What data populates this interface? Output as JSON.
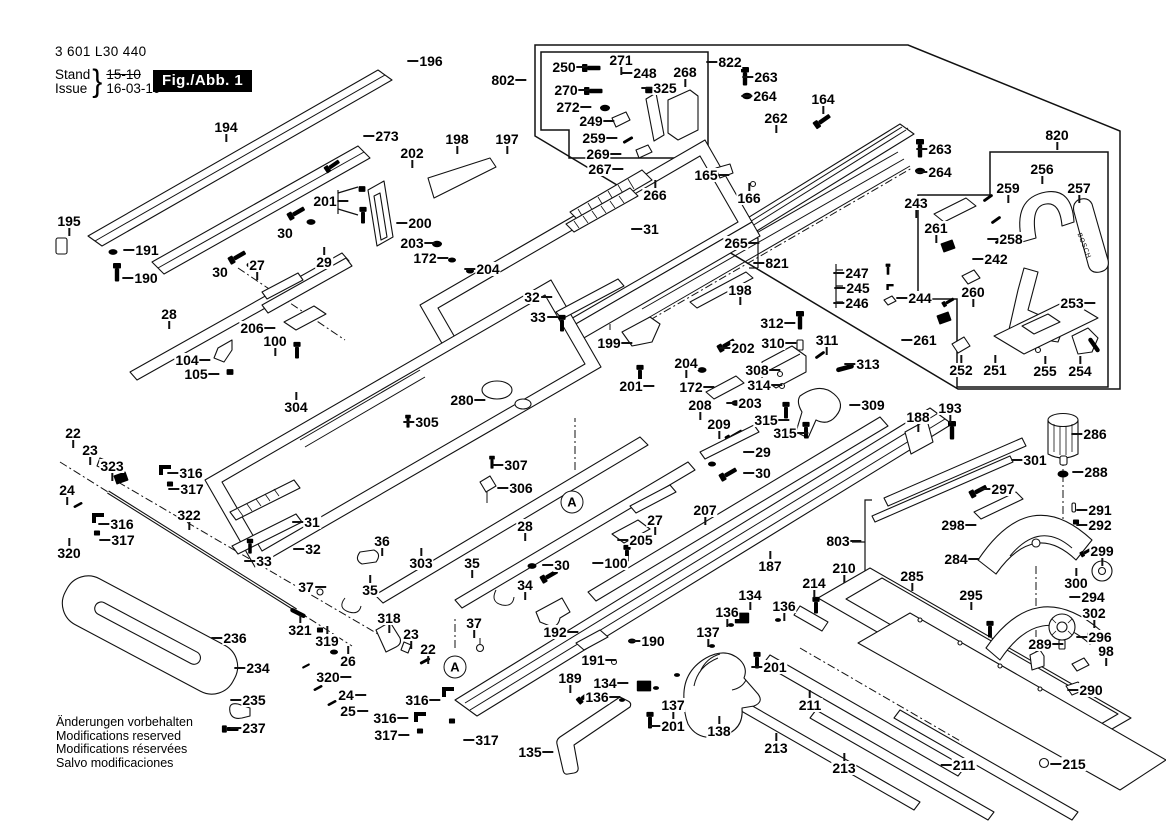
{
  "doc": {
    "part_number": "3 601 L30 440",
    "stand_label": "Stand",
    "issue_label": "Issue",
    "stand_value": "15-10",
    "issue_value": "16-03-10",
    "figure_badge": "Fig./Abb. 1",
    "footer_lines": [
      "Änderungen vorbehalten",
      "Modifications reserved",
      "Modifications réservées",
      "Salvo modificaciones"
    ],
    "brand_on_part": "BOSCH",
    "detail_marker": "A"
  },
  "markers": [
    {
      "t": "A",
      "x": 572,
      "y": 502
    },
    {
      "t": "A",
      "x": 455,
      "y": 667
    }
  ],
  "labels": [
    {
      "t": "194",
      "x": 226,
      "y": 127,
      "d": "b"
    },
    {
      "t": "196",
      "x": 431,
      "y": 61,
      "d": "l"
    },
    {
      "t": "273",
      "x": 387,
      "y": 136,
      "d": "l"
    },
    {
      "t": "198",
      "x": 457,
      "y": 139,
      "d": "b"
    },
    {
      "t": "197",
      "x": 507,
      "y": 139,
      "d": "b"
    },
    {
      "t": "202",
      "x": 412,
      "y": 153,
      "d": "b"
    },
    {
      "t": "195",
      "x": 69,
      "y": 221,
      "d": "b"
    },
    {
      "t": "191",
      "x": 147,
      "y": 250,
      "d": "l"
    },
    {
      "t": "190",
      "x": 146,
      "y": 278,
      "d": "l"
    },
    {
      "t": "201",
      "x": 325,
      "y": 201,
      "d": "r"
    },
    {
      "t": "30",
      "x": 285,
      "y": 233
    },
    {
      "t": "30",
      "x": 220,
      "y": 272
    },
    {
      "t": "27",
      "x": 257,
      "y": 265,
      "d": "b"
    },
    {
      "t": "29",
      "x": 324,
      "y": 262,
      "d": "t"
    },
    {
      "t": "200",
      "x": 420,
      "y": 223,
      "d": "l"
    },
    {
      "t": "203",
      "x": 412,
      "y": 243,
      "d": "r"
    },
    {
      "t": "172",
      "x": 425,
      "y": 258,
      "d": "r"
    },
    {
      "t": "204",
      "x": 488,
      "y": 269,
      "d": "l"
    },
    {
      "t": "28",
      "x": 169,
      "y": 314,
      "d": "b"
    },
    {
      "t": "206",
      "x": 252,
      "y": 328,
      "d": "r"
    },
    {
      "t": "100",
      "x": 275,
      "y": 341,
      "d": "b"
    },
    {
      "t": "104",
      "x": 187,
      "y": 360,
      "d": "r"
    },
    {
      "t": "105",
      "x": 196,
      "y": 374,
      "d": "r"
    },
    {
      "t": "304",
      "x": 296,
      "y": 407,
      "d": "t"
    },
    {
      "t": "802",
      "x": 503,
      "y": 80,
      "d": "r"
    },
    {
      "t": "250",
      "x": 564,
      "y": 67,
      "d": "r"
    },
    {
      "t": "271",
      "x": 621,
      "y": 60,
      "d": "b"
    },
    {
      "t": "248",
      "x": 645,
      "y": 73,
      "d": "l"
    },
    {
      "t": "268",
      "x": 685,
      "y": 72,
      "d": "b"
    },
    {
      "t": "325",
      "x": 665,
      "y": 88,
      "d": "l"
    },
    {
      "t": "270",
      "x": 566,
      "y": 90,
      "d": "r"
    },
    {
      "t": "272",
      "x": 568,
      "y": 107,
      "d": "r"
    },
    {
      "t": "249",
      "x": 591,
      "y": 121,
      "d": "r"
    },
    {
      "t": "259",
      "x": 594,
      "y": 138,
      "d": "r"
    },
    {
      "t": "269",
      "x": 598,
      "y": 154,
      "d": "r"
    },
    {
      "t": "267",
      "x": 600,
      "y": 169,
      "d": "r"
    },
    {
      "t": "266",
      "x": 655,
      "y": 195,
      "d": "t"
    },
    {
      "t": "822",
      "x": 730,
      "y": 62,
      "d": "l"
    },
    {
      "t": "263",
      "x": 766,
      "y": 77,
      "d": "l"
    },
    {
      "t": "264",
      "x": 765,
      "y": 96,
      "d": "l"
    },
    {
      "t": "164",
      "x": 823,
      "y": 99,
      "d": "b"
    },
    {
      "t": "262",
      "x": 776,
      "y": 118,
      "d": "b"
    },
    {
      "t": "263",
      "x": 940,
      "y": 149,
      "d": "l"
    },
    {
      "t": "264",
      "x": 940,
      "y": 172,
      "d": "l"
    },
    {
      "t": "820",
      "x": 1057,
      "y": 135,
      "d": "b"
    },
    {
      "t": "256",
      "x": 1042,
      "y": 169,
      "d": "b"
    },
    {
      "t": "259",
      "x": 1008,
      "y": 188,
      "d": "b"
    },
    {
      "t": "257",
      "x": 1079,
      "y": 188,
      "d": "b"
    },
    {
      "t": "258",
      "x": 1011,
      "y": 239,
      "d": "l"
    },
    {
      "t": "242",
      "x": 996,
      "y": 259,
      "d": "l"
    },
    {
      "t": "243",
      "x": 916,
      "y": 203,
      "d": "b"
    },
    {
      "t": "261",
      "x": 936,
      "y": 228,
      "d": "b"
    },
    {
      "t": "165",
      "x": 706,
      "y": 175,
      "d": "r"
    },
    {
      "t": "166",
      "x": 749,
      "y": 198,
      "d": "t"
    },
    {
      "t": "31",
      "x": 651,
      "y": 229,
      "d": "l"
    },
    {
      "t": "265",
      "x": 736,
      "y": 243,
      "d": "r"
    },
    {
      "t": "821",
      "x": 777,
      "y": 263,
      "d": "l"
    },
    {
      "t": "247",
      "x": 857,
      "y": 273,
      "d": "l"
    },
    {
      "t": "245",
      "x": 858,
      "y": 288,
      "d": "l"
    },
    {
      "t": "246",
      "x": 857,
      "y": 303,
      "d": "l"
    },
    {
      "t": "244",
      "x": 920,
      "y": 298,
      "d": "l"
    },
    {
      "t": "260",
      "x": 973,
      "y": 292,
      "d": "b"
    },
    {
      "t": "253",
      "x": 1072,
      "y": 303,
      "d": "r"
    },
    {
      "t": "261",
      "x": 925,
      "y": 340,
      "d": "l"
    },
    {
      "t": "252",
      "x": 961,
      "y": 370,
      "d": "t"
    },
    {
      "t": "251",
      "x": 995,
      "y": 370,
      "d": "t"
    },
    {
      "t": "255",
      "x": 1045,
      "y": 371,
      "d": "t"
    },
    {
      "t": "254",
      "x": 1080,
      "y": 371,
      "d": "t"
    },
    {
      "t": "313",
      "x": 868,
      "y": 364,
      "d": "l"
    },
    {
      "t": "312",
      "x": 772,
      "y": 323,
      "d": "r"
    },
    {
      "t": "310",
      "x": 773,
      "y": 343,
      "d": "r"
    },
    {
      "t": "311",
      "x": 827,
      "y": 340,
      "d": "b"
    },
    {
      "t": "308",
      "x": 757,
      "y": 370,
      "d": "r"
    },
    {
      "t": "314",
      "x": 759,
      "y": 385,
      "d": "r"
    },
    {
      "t": "309",
      "x": 873,
      "y": 405,
      "d": "l"
    },
    {
      "t": "315",
      "x": 766,
      "y": 420,
      "d": "r"
    },
    {
      "t": "315",
      "x": 785,
      "y": 433,
      "d": "r"
    },
    {
      "t": "188",
      "x": 918,
      "y": 417,
      "d": "b"
    },
    {
      "t": "193",
      "x": 950,
      "y": 408,
      "d": "b"
    },
    {
      "t": "198",
      "x": 740,
      "y": 290,
      "d": "b"
    },
    {
      "t": "202",
      "x": 743,
      "y": 348,
      "d": "l"
    },
    {
      "t": "204",
      "x": 686,
      "y": 363,
      "d": "b"
    },
    {
      "t": "172",
      "x": 691,
      "y": 387,
      "d": "r"
    },
    {
      "t": "203",
      "x": 750,
      "y": 403,
      "d": "l"
    },
    {
      "t": "201",
      "x": 631,
      "y": 386,
      "d": "r"
    },
    {
      "t": "208",
      "x": 700,
      "y": 405,
      "d": "b"
    },
    {
      "t": "209",
      "x": 719,
      "y": 424,
      "d": "b"
    },
    {
      "t": "29",
      "x": 763,
      "y": 452,
      "d": "l"
    },
    {
      "t": "30",
      "x": 763,
      "y": 473,
      "d": "l"
    },
    {
      "t": "32",
      "x": 532,
      "y": 297,
      "d": "r"
    },
    {
      "t": "33",
      "x": 538,
      "y": 317,
      "d": "r"
    },
    {
      "t": "199",
      "x": 609,
      "y": 343,
      "d": "r"
    },
    {
      "t": "280",
      "x": 462,
      "y": 400,
      "d": "r"
    },
    {
      "t": "305",
      "x": 427,
      "y": 422,
      "d": "l"
    },
    {
      "t": "307",
      "x": 516,
      "y": 465,
      "d": "l"
    },
    {
      "t": "306",
      "x": 521,
      "y": 488,
      "d": "l"
    },
    {
      "t": "301",
      "x": 1035,
      "y": 460,
      "d": "l"
    },
    {
      "t": "286",
      "x": 1095,
      "y": 434,
      "d": "l"
    },
    {
      "t": "288",
      "x": 1096,
      "y": 472,
      "d": "l"
    },
    {
      "t": "297",
      "x": 1003,
      "y": 489,
      "d": "l"
    },
    {
      "t": "298",
      "x": 953,
      "y": 525,
      "d": "r"
    },
    {
      "t": "291",
      "x": 1100,
      "y": 510,
      "d": "l"
    },
    {
      "t": "292",
      "x": 1100,
      "y": 525,
      "d": "l"
    },
    {
      "t": "284",
      "x": 956,
      "y": 559,
      "d": "r"
    },
    {
      "t": "299",
      "x": 1102,
      "y": 551,
      "d": "b"
    },
    {
      "t": "300",
      "x": 1076,
      "y": 583,
      "d": "t"
    },
    {
      "t": "294",
      "x": 1093,
      "y": 597,
      "d": "l"
    },
    {
      "t": "302",
      "x": 1094,
      "y": 613,
      "d": "b"
    },
    {
      "t": "285",
      "x": 912,
      "y": 576,
      "d": "b"
    },
    {
      "t": "295",
      "x": 971,
      "y": 595,
      "d": "b"
    },
    {
      "t": "289",
      "x": 1040,
      "y": 644,
      "d": "r"
    },
    {
      "t": "296",
      "x": 1100,
      "y": 637,
      "d": "l"
    },
    {
      "t": "98",
      "x": 1106,
      "y": 651,
      "d": "b"
    },
    {
      "t": "290",
      "x": 1091,
      "y": 690,
      "d": "l"
    },
    {
      "t": "22",
      "x": 73,
      "y": 433,
      "d": "b"
    },
    {
      "t": "23",
      "x": 90,
      "y": 450,
      "d": "b"
    },
    {
      "t": "323",
      "x": 112,
      "y": 466,
      "d": "b"
    },
    {
      "t": "24",
      "x": 67,
      "y": 490,
      "d": "b"
    },
    {
      "t": "316",
      "x": 191,
      "y": 473,
      "d": "l"
    },
    {
      "t": "317",
      "x": 192,
      "y": 489,
      "d": "l"
    },
    {
      "t": "316",
      "x": 122,
      "y": 524,
      "d": "l"
    },
    {
      "t": "317",
      "x": 123,
      "y": 540,
      "d": "l"
    },
    {
      "t": "320",
      "x": 69,
      "y": 553,
      "d": "t"
    },
    {
      "t": "322",
      "x": 189,
      "y": 515,
      "d": "b"
    },
    {
      "t": "31",
      "x": 312,
      "y": 522,
      "d": "l"
    },
    {
      "t": "32",
      "x": 313,
      "y": 549,
      "d": "l"
    },
    {
      "t": "33",
      "x": 264,
      "y": 561,
      "d": "l"
    },
    {
      "t": "36",
      "x": 382,
      "y": 541,
      "d": "b"
    },
    {
      "t": "35",
      "x": 370,
      "y": 590,
      "d": "t"
    },
    {
      "t": "37",
      "x": 306,
      "y": 587,
      "d": "r"
    },
    {
      "t": "303",
      "x": 421,
      "y": 563,
      "d": "t"
    },
    {
      "t": "35",
      "x": 472,
      "y": 563,
      "d": "b"
    },
    {
      "t": "34",
      "x": 525,
      "y": 585,
      "d": "b"
    },
    {
      "t": "28",
      "x": 525,
      "y": 526,
      "d": "b"
    },
    {
      "t": "205",
      "x": 641,
      "y": 540,
      "d": "l"
    },
    {
      "t": "27",
      "x": 655,
      "y": 520,
      "d": "b"
    },
    {
      "t": "100",
      "x": 616,
      "y": 563,
      "d": "l"
    },
    {
      "t": "30",
      "x": 562,
      "y": 565,
      "d": "l"
    },
    {
      "t": "207",
      "x": 705,
      "y": 510,
      "d": "b"
    },
    {
      "t": "187",
      "x": 770,
      "y": 566,
      "d": "t"
    },
    {
      "t": "803",
      "x": 838,
      "y": 541,
      "d": "r"
    },
    {
      "t": "210",
      "x": 844,
      "y": 568,
      "d": "b"
    },
    {
      "t": "214",
      "x": 814,
      "y": 583,
      "d": "b"
    },
    {
      "t": "37",
      "x": 474,
      "y": 623,
      "d": "b"
    },
    {
      "t": "318",
      "x": 389,
      "y": 618,
      "d": "b"
    },
    {
      "t": "23",
      "x": 411,
      "y": 634,
      "d": "b"
    },
    {
      "t": "22",
      "x": 428,
      "y": 649,
      "d": "b"
    },
    {
      "t": "319",
      "x": 327,
      "y": 641,
      "d": "t"
    },
    {
      "t": "26",
      "x": 348,
      "y": 661,
      "d": "t"
    },
    {
      "t": "320",
      "x": 328,
      "y": 677,
      "d": "r"
    },
    {
      "t": "24",
      "x": 346,
      "y": 695,
      "d": "r"
    },
    {
      "t": "25",
      "x": 348,
      "y": 711,
      "d": "r"
    },
    {
      "t": "321",
      "x": 300,
      "y": 630,
      "d": "t"
    },
    {
      "t": "236",
      "x": 235,
      "y": 638,
      "d": "l"
    },
    {
      "t": "234",
      "x": 258,
      "y": 668,
      "d": "l"
    },
    {
      "t": "235",
      "x": 254,
      "y": 700,
      "d": "l"
    },
    {
      "t": "237",
      "x": 254,
      "y": 728,
      "d": "l"
    },
    {
      "t": "316",
      "x": 417,
      "y": 700,
      "d": "r"
    },
    {
      "t": "316",
      "x": 385,
      "y": 718,
      "d": "r"
    },
    {
      "t": "317",
      "x": 386,
      "y": 735,
      "d": "r"
    },
    {
      "t": "317",
      "x": 487,
      "y": 740,
      "d": "l"
    },
    {
      "t": "192",
      "x": 555,
      "y": 632,
      "d": "r"
    },
    {
      "t": "190",
      "x": 653,
      "y": 641,
      "d": "l"
    },
    {
      "t": "191",
      "x": 593,
      "y": 660,
      "d": "r"
    },
    {
      "t": "189",
      "x": 570,
      "y": 678,
      "d": "b"
    },
    {
      "t": "134",
      "x": 605,
      "y": 683,
      "d": "r"
    },
    {
      "t": "136",
      "x": 597,
      "y": 697,
      "d": "r"
    },
    {
      "t": "137",
      "x": 673,
      "y": 705,
      "d": "b"
    },
    {
      "t": "201",
      "x": 673,
      "y": 726,
      "d": "l"
    },
    {
      "t": "138",
      "x": 719,
      "y": 731,
      "d": "t"
    },
    {
      "t": "134",
      "x": 750,
      "y": 595,
      "d": "b"
    },
    {
      "t": "136",
      "x": 727,
      "y": 612,
      "d": "b"
    },
    {
      "t": "136",
      "x": 784,
      "y": 606,
      "d": "b"
    },
    {
      "t": "137",
      "x": 708,
      "y": 632,
      "d": "b"
    },
    {
      "t": "201",
      "x": 775,
      "y": 667,
      "d": "l"
    },
    {
      "t": "135",
      "x": 530,
      "y": 752,
      "d": "r"
    },
    {
      "t": "211",
      "x": 810,
      "y": 705,
      "d": "t"
    },
    {
      "t": "213",
      "x": 776,
      "y": 748,
      "d": "t"
    },
    {
      "t": "213",
      "x": 844,
      "y": 768,
      "d": "t"
    },
    {
      "t": "211",
      "x": 964,
      "y": 765,
      "d": "l"
    },
    {
      "t": "215",
      "x": 1074,
      "y": 764,
      "d": "l"
    }
  ]
}
